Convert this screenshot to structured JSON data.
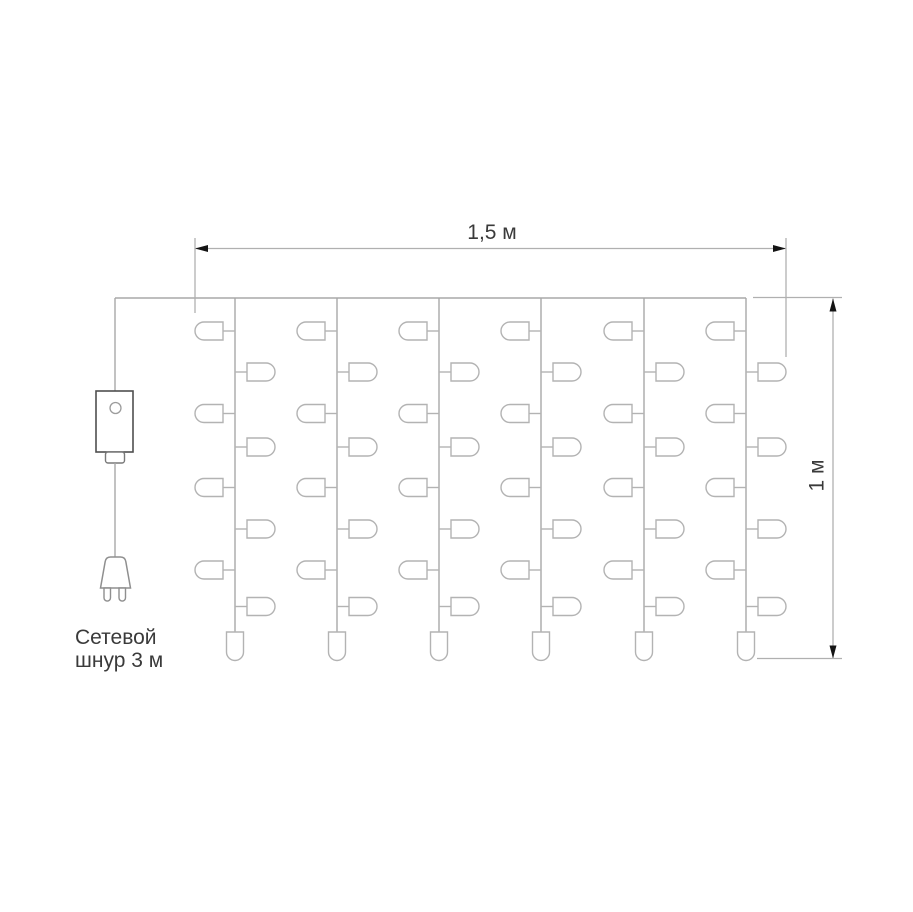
{
  "diagram": {
    "width_label": "1,5 м",
    "height_label": "1 м",
    "cord_label_lines": [
      "Сетевой",
      "шнур 3 м"
    ],
    "curtain": {
      "strand_count": 6,
      "strand_x": [
        235,
        337,
        439,
        541,
        644,
        746
      ],
      "wire_start_x": 115,
      "wire_y": 298,
      "strand_bottom_y": 632,
      "left_bulb_y": [
        331,
        413.5,
        487.5,
        570
      ],
      "right_bulb_y": [
        372,
        447,
        529,
        606.5
      ],
      "bulb_length": 28,
      "bulb_height": 18,
      "stub_length": 12,
      "end_bulb_width": 17,
      "end_bulb_height": 28.5
    },
    "power": {
      "cord_x": 115,
      "box": {
        "x": 96,
        "y": 391,
        "w": 37,
        "h": 61
      },
      "button_circle": {
        "cx": 115.5,
        "cy": 408,
        "r": 5.5
      },
      "outlet": {
        "x": 105.5,
        "y": 452,
        "w": 19,
        "h": 11
      },
      "plug_top_y": 557,
      "plug_bottom_y": 588,
      "prong_bottom_y": 601
    },
    "dimensions": {
      "horizontal": {
        "y": 248.5,
        "x1": 195,
        "x2": 786,
        "ext_top": 238,
        "ext_left_bottom": 313,
        "ext_right_bottom": 357
      },
      "vertical": {
        "x": 833,
        "y1": 298.5,
        "y2": 658.5,
        "ext_top_y": 297.5,
        "ext_bottom_y": 658.5,
        "ext_x1_top": 753,
        "ext_x1_bottom": 757,
        "ext_x2": 842
      }
    },
    "colors": {
      "background": "#ffffff",
      "wire": "#a8a8a8",
      "bulb_outline": "#b3b3b3",
      "controller_outline": "#4f4f4f",
      "controller_button": "#9c9c9c",
      "outlet_outline": "#787878",
      "plug_outline": "#8f8f8f",
      "dimension_line": "#b0b0b0",
      "arrow": "#141414",
      "text": "#3a3a3a"
    }
  }
}
